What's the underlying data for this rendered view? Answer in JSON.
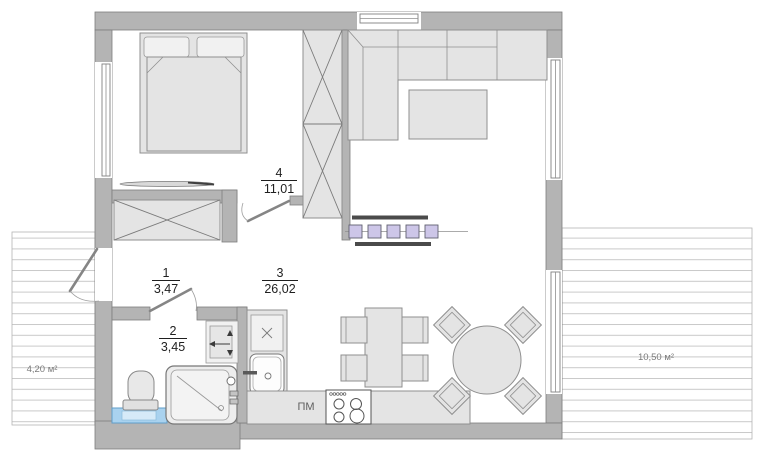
{
  "plan": {
    "rooms": {
      "hall": {
        "number": "1",
        "area": "3,47"
      },
      "bathroom": {
        "number": "2",
        "area": "3,45"
      },
      "living_kitchen": {
        "number": "3",
        "area": "26,02"
      },
      "bedroom": {
        "number": "4",
        "area": "11,01"
      }
    },
    "terraces": {
      "left": {
        "area": "4,20 м²"
      },
      "right": {
        "area": "10,50 м²"
      }
    },
    "labels": {
      "dishwasher": "ПМ"
    },
    "colors": {
      "wall": "#b4b4b4",
      "furniture": "#e4e4e4",
      "radiator": "#cdc6e8",
      "water_blue": "#a9d2ef"
    }
  }
}
